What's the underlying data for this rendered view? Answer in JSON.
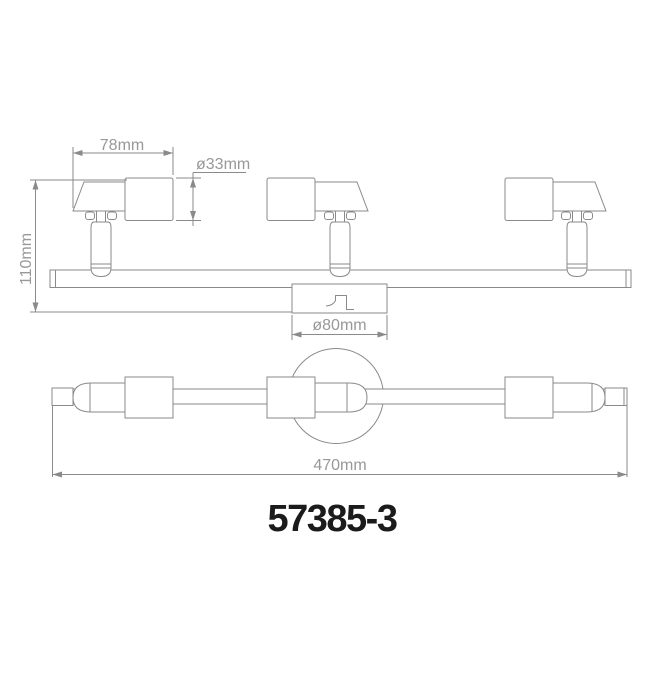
{
  "drawing": {
    "model_number": "57385-3",
    "dimensions": {
      "head_width": "78mm",
      "head_diameter": "ø33mm",
      "height": "110mm",
      "canopy_diameter": "ø80mm",
      "overall_length": "470mm"
    },
    "colors": {
      "line": "#8a8a8a",
      "dim_text": "#989898",
      "model_text": "#1b1b1b",
      "background": "#ffffff"
    }
  }
}
